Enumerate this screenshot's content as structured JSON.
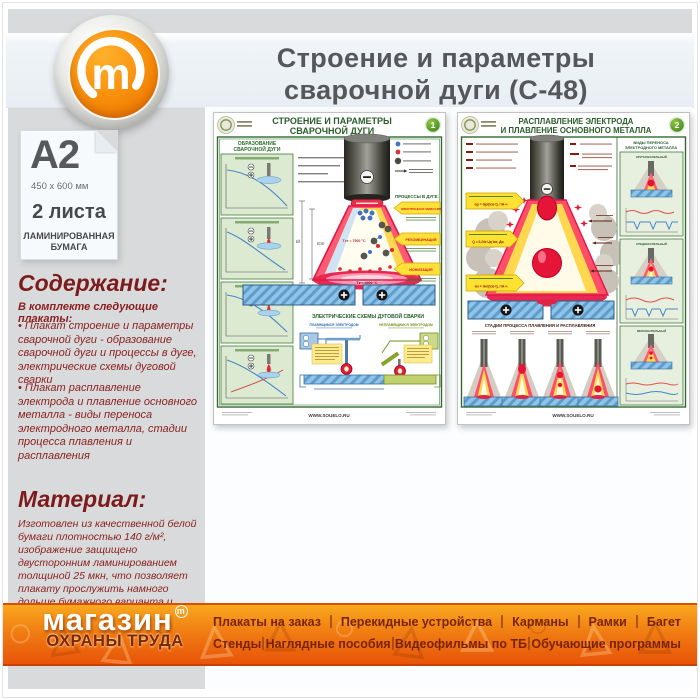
{
  "page": {
    "title_line1": "Строение и параметры",
    "title_line2": "сварочной дуги (С-48)"
  },
  "logo": {
    "letter": "m"
  },
  "sidebar": {
    "format": "A2",
    "size": "450 x 600 мм",
    "sheets": "2 листа",
    "paper_line1": "ЛАМИНИРОВАННАЯ",
    "paper_line2": "БУМАГА",
    "contents": {
      "heading": "Содержание:",
      "intro": "В комплекте следующие плакаты:",
      "items": [
        "• Плакат строение и параметры сварочной дуги - образование сварочной дуги и процессы в дуге, электрические схемы дуговой сварки",
        "• Плакат расплавление электрода и плавление основного металла - виды переноса электродного металла,  стадии процесса плавления и расплавления"
      ]
    },
    "material": {
      "heading": "Материал:",
      "text": "Изготовлен из качественной белой бумаги плотностью 140 г/м², изображение защищено двусторонним ламинированием толщиной 25 мкн, что позволяет плакату прослужить намного дольше бумажного варианта и такой плакат не боится влаги - его смело можно протирать."
    }
  },
  "posters": [
    {
      "badge": "1",
      "title_line1": "СТРОЕНИЕ И ПАРАМЕТРЫ",
      "title_line2": "СВАРОЧНОЙ ДУГИ",
      "left_heading_line1": "ОБРАЗОВАНИЕ",
      "left_heading_line2": "СВАРОЧНОЙ ДУГИ",
      "processes_heading": "ПРОЦЕССЫ В ДУГЕ:",
      "process_arrows": [
        "ЭЛЕКТРОННАЯ ЭМИССИЯ",
        "РЕКОМБИНАЦИЯ",
        "ИОНИЗАЦИЯ"
      ],
      "temp_column": "Tст ≈ 7500 °C",
      "temp_anode": "Tк ≈ 4000 °C",
      "dim_labels": [
        "ℓд",
        "ℓст"
      ],
      "schemes_heading": "ЭЛЕКТРИЧЕСКИЕ СХЕМЫ ДУГОВОЙ СВАРКИ",
      "scheme_left": "ПЛАВЯЩИМСЯ ЭЛЕКТРОДОМ",
      "scheme_right": "НЕПЛАВЯЩИМСЯ ЭЛЕКТРОДОМ",
      "website": "WWW.SOUELO.RU"
    },
    {
      "badge": "2",
      "title_line1": "РАСПЛАВЛЕНИЕ ЭЛЕКТРОДА",
      "title_line2": "И ПЛАВЛЕНИЕ ОСНОВНОГО МЕТАЛЛА",
      "transfer_heading_line1": "ВИДЫ ПЕРЕНОСА",
      "transfer_heading_line2": "ЭЛЕКТРОДНОГО МЕТАЛЛА",
      "transfer_types": [
        "КРУПНОКАПЕЛЬНЫЙ",
        "СРЕДНЕКАПЕЛЬНЫЙ",
        "МЕЛКОКАПЕЛЬНЫЙ"
      ],
      "formulas": [
        "αр = Gр/(Iсв·t), г/А·ч",
        "αн = Gн/(Iсв·t), г/А·ч"
      ],
      "heat_formula": "Q = 0,24к·Uд·Iсв, Дж",
      "stages_heading": "СТАДИИ ПРОЦЕССА ПЛАВЛЕНИЯ И РАСПЛАВЛЕНИЯ",
      "website": "WWW.SOUELO.RU"
    }
  ],
  "footer": {
    "brand_line1": "магазин",
    "brand_reg_letter": "m",
    "brand_line2": "ОХРАНЫ ТРУДА",
    "wm_triangle": "△",
    "wm_circle": "○",
    "menu_row1": [
      "Плакаты на заказ",
      "Перекидные устройства",
      "Карманы",
      "Рамки",
      "Багет"
    ],
    "menu_row2": [
      "Стенды",
      "Наглядные пособия",
      "Видеофильмы по ТБ",
      "Обучающие программы"
    ]
  },
  "colors": {
    "accent_orange": "#f07b12",
    "heading_maroon": "#7b1b1b",
    "poster_green": "#2a5c2a",
    "arc_red": "#e8315b",
    "arc_yellow": "#ffd84f",
    "slab_blue": "#7ab7e0",
    "title_gray": "#55575a"
  }
}
